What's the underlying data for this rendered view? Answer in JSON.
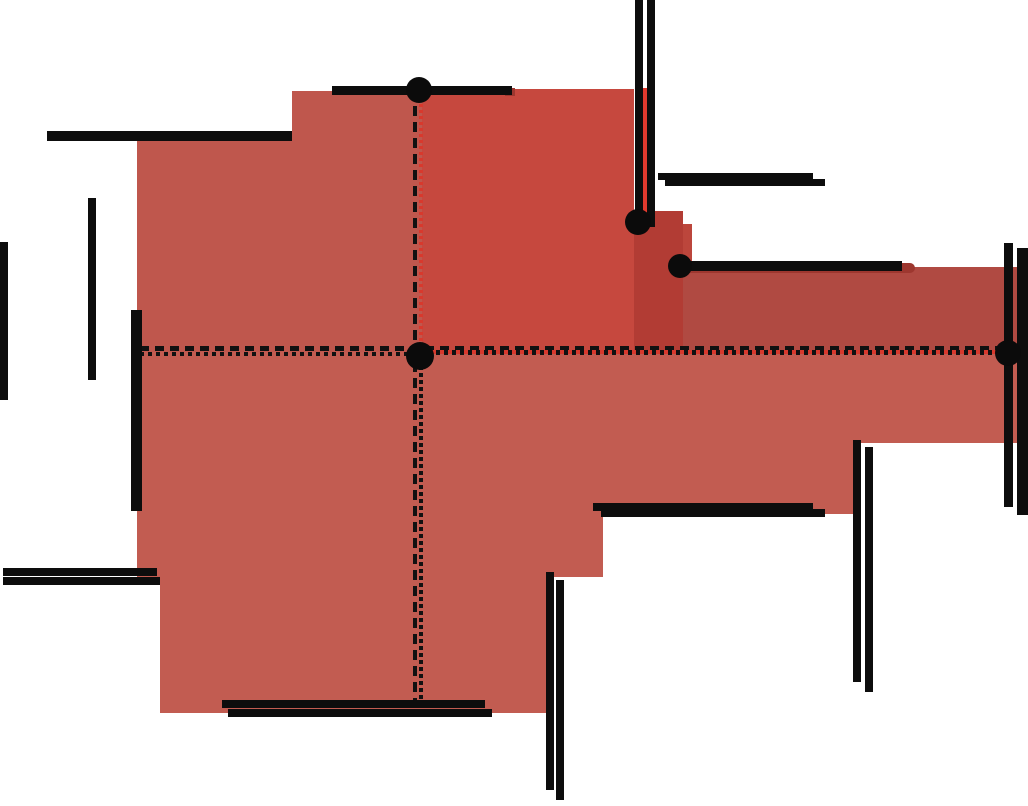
{
  "figure": {
    "description": "Rectilinear quadrant visibility diagram around query point q with shaded visible regions and black axis-parallel segments"
  },
  "colors": {
    "salmon_upper": "#bf574d",
    "salmon_lower": "#c25c51",
    "red_dark": "#c6483e",
    "column_dark": "#b23c34",
    "column_sliver": "#bc463c",
    "arm_dark": "#b04a42",
    "red_bright": "#e23a2e",
    "red_cap": "#9d372f",
    "segment_black": "#0d0d0d",
    "dot_black": "#0b0b0b",
    "dash_red": "#d8392d"
  },
  "labels": {
    "q2": {
      "main": "Q",
      "sub": "2"
    },
    "q3": {
      "main": "Q",
      "sub": "3"
    },
    "q4": {
      "main": "Q",
      "sub": "4"
    },
    "q": {
      "text": "q"
    }
  },
  "regions": [
    {
      "name": "region-q2-left-upper",
      "x": 137,
      "y": 137,
      "w": 155,
      "h": 215,
      "color": "salmon_upper"
    },
    {
      "name": "region-q2-left-step",
      "x": 292,
      "y": 91,
      "w": 130,
      "h": 261,
      "color": "salmon_upper"
    },
    {
      "name": "region-q2-right-dark",
      "x": 422,
      "y": 89,
      "w": 212,
      "h": 263,
      "color": "red_dark"
    },
    {
      "name": "region-column-dark",
      "x": 634,
      "y": 211,
      "w": 49,
      "h": 141,
      "color": "column_dark"
    },
    {
      "name": "region-column-sliver",
      "x": 683,
      "y": 224,
      "w": 9,
      "h": 128,
      "color": "column_sliver"
    },
    {
      "name": "region-right-arm-dark",
      "x": 683,
      "y": 267,
      "w": 335,
      "h": 85,
      "color": "arm_dark"
    },
    {
      "name": "region-south-slab-1",
      "x": 137,
      "y": 352,
      "w": 881,
      "h": 91,
      "color": "salmon_lower"
    },
    {
      "name": "region-south-slab-2",
      "x": 137,
      "y": 443,
      "w": 716,
      "h": 71,
      "color": "salmon_lower"
    },
    {
      "name": "region-south-slab-3",
      "x": 137,
      "y": 514,
      "w": 466,
      "h": 63,
      "color": "salmon_lower"
    },
    {
      "name": "region-south-slab-4",
      "x": 160,
      "y": 577,
      "w": 390,
      "h": 136,
      "color": "salmon_lower"
    }
  ],
  "red_marks": [
    {
      "name": "red-segment-vertical-top",
      "x": 642,
      "y": 88,
      "w": 5,
      "h": 124,
      "color": "red_bright",
      "rounded": false
    },
    {
      "name": "red-cap-right-arm",
      "x": 685,
      "y": 263,
      "w": 230,
      "h": 10,
      "color": "red_cap",
      "rounded": true
    },
    {
      "name": "red-cap-top-segment",
      "x": 505,
      "y": 88,
      "w": 10,
      "h": 8,
      "color": "red_cap",
      "rounded": false
    }
  ],
  "segments": [
    {
      "name": "segment-h-topleft",
      "x": 47,
      "y": 131,
      "w": 245,
      "h": 10
    },
    {
      "name": "segment-h-top-through-dot",
      "x": 332,
      "y": 86,
      "w": 180,
      "h": 9
    },
    {
      "name": "segment-h-upper-right-a",
      "x": 658,
      "y": 173,
      "w": 155,
      "h": 7
    },
    {
      "name": "segment-h-upper-right-b",
      "x": 665,
      "y": 179,
      "w": 160,
      "h": 7
    },
    {
      "name": "segment-h-arm",
      "x": 680,
      "y": 261,
      "w": 222,
      "h": 10
    },
    {
      "name": "segment-h-mid-right-a",
      "x": 593,
      "y": 503,
      "w": 220,
      "h": 8
    },
    {
      "name": "segment-h-mid-right-b",
      "x": 601,
      "y": 509,
      "w": 224,
      "h": 8
    },
    {
      "name": "segment-h-left-lower-a",
      "x": 3,
      "y": 568,
      "w": 154,
      "h": 8
    },
    {
      "name": "segment-h-left-lower-b",
      "x": 3,
      "y": 577,
      "w": 157,
      "h": 8
    },
    {
      "name": "segment-h-bottom-a",
      "x": 222,
      "y": 700,
      "w": 263,
      "h": 8
    },
    {
      "name": "segment-h-bottom-b",
      "x": 228,
      "y": 709,
      "w": 264,
      "h": 8
    },
    {
      "name": "segment-v-left-edge",
      "x": 0,
      "y": 242,
      "w": 8,
      "h": 158
    },
    {
      "name": "segment-v-left-mid",
      "x": 88,
      "y": 198,
      "w": 8,
      "h": 182
    },
    {
      "name": "segment-v-red-border",
      "x": 131,
      "y": 310,
      "w": 11,
      "h": 201
    },
    {
      "name": "segment-v-top-a",
      "x": 635,
      "y": 0,
      "w": 8,
      "h": 211
    },
    {
      "name": "segment-v-top-b",
      "x": 647,
      "y": 0,
      "w": 8,
      "h": 227
    },
    {
      "name": "segment-v-right-mid-a",
      "x": 853,
      "y": 440,
      "w": 8,
      "h": 242
    },
    {
      "name": "segment-v-right-mid-b",
      "x": 865,
      "y": 447,
      "w": 8,
      "h": 245
    },
    {
      "name": "segment-v-far-right-a",
      "x": 1004,
      "y": 243,
      "w": 9,
      "h": 264
    },
    {
      "name": "segment-v-far-right-b",
      "x": 1017,
      "y": 248,
      "w": 11,
      "h": 267
    },
    {
      "name": "segment-v-bottom-a",
      "x": 546,
      "y": 572,
      "w": 8,
      "h": 218
    },
    {
      "name": "segment-v-bottom-b",
      "x": 556,
      "y": 580,
      "w": 8,
      "h": 220
    }
  ],
  "dashes": [
    {
      "name": "dashed-vertical-main",
      "x": 413,
      "y": 90,
      "w": 4,
      "h": 612,
      "cls": "dash-v-main"
    },
    {
      "name": "dashed-vertical-red-upper",
      "x": 419,
      "y": 92,
      "w": 4,
      "h": 260,
      "cls": "dash-v-red"
    },
    {
      "name": "dashed-vertical-dense-lower",
      "x": 419,
      "y": 352,
      "w": 4,
      "h": 350,
      "cls": "dash-v-dense"
    },
    {
      "name": "dashed-horizontal-main",
      "x": 140,
      "y": 346,
      "w": 868,
      "h": 5,
      "cls": "dash-h-main"
    },
    {
      "name": "dashed-horizontal-dense-left",
      "x": 140,
      "y": 352,
      "w": 280,
      "h": 4,
      "cls": "dash-h-dense"
    },
    {
      "name": "dashed-horizontal-red-right",
      "x": 420,
      "y": 350,
      "w": 588,
      "h": 4,
      "cls": "red-line"
    },
    {
      "name": "dashed-horizontal-dense-right",
      "x": 420,
      "y": 350,
      "w": 588,
      "h": 5,
      "cls": "dash-h-dense"
    }
  ],
  "dots": [
    {
      "name": "dot-top-segment",
      "cx": 419,
      "cy": 90,
      "r": 13
    },
    {
      "name": "dot-upper-right",
      "cx": 638,
      "cy": 222,
      "r": 13
    },
    {
      "name": "dot-arm-left-end",
      "cx": 680,
      "cy": 266,
      "r": 12
    },
    {
      "name": "dot-right-end",
      "cx": 1008,
      "cy": 353,
      "r": 13
    },
    {
      "name": "dot-query-point",
      "cx": 420,
      "cy": 356,
      "r": 14
    }
  ]
}
